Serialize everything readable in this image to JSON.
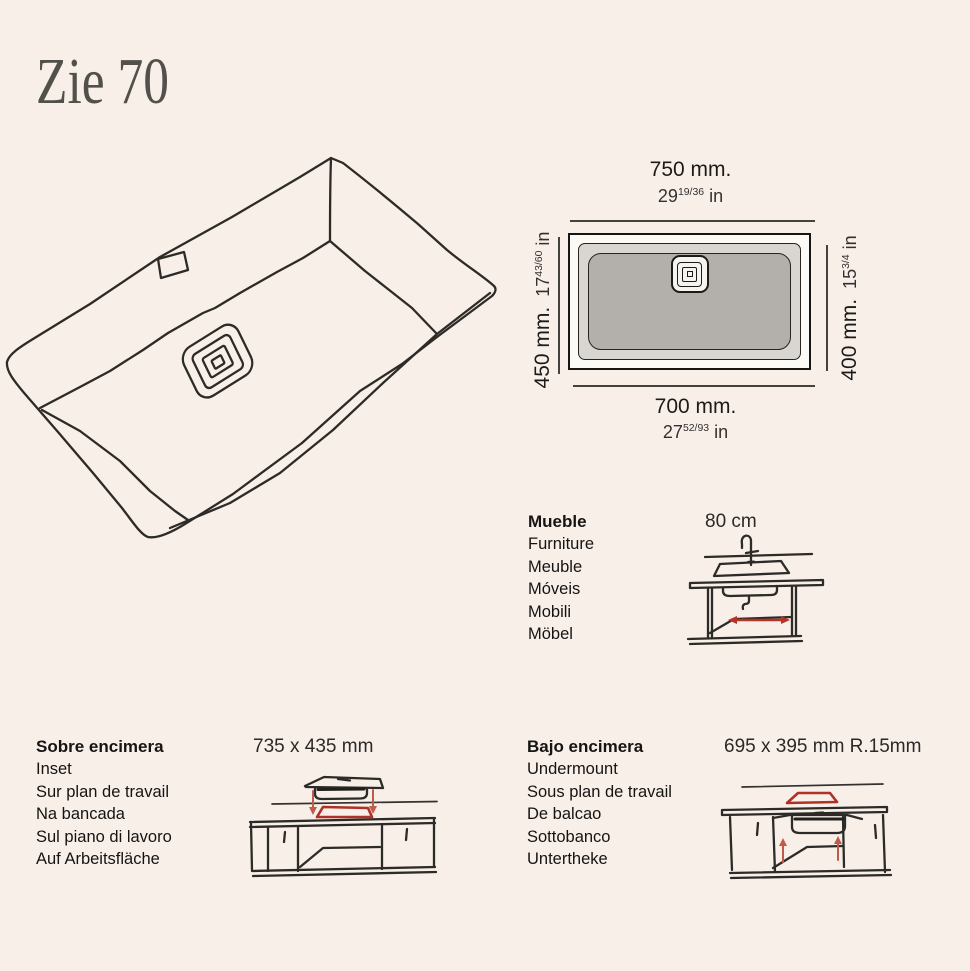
{
  "title": "Zie 70",
  "colors": {
    "background": "#f8efe9",
    "line_ink": "#2d2b27",
    "accent_red": "#ad3227",
    "basin_gray": "#b3b0ac",
    "rim_gray": "#d9d6d2"
  },
  "dimension_diagram": {
    "width_top": {
      "mm": "750 mm.",
      "in_whole": "29",
      "in_frac": "19/36",
      "in_unit": "in"
    },
    "width_bottom": {
      "mm": "700 mm.",
      "in_whole": "27",
      "in_frac": "52/93",
      "in_unit": "in"
    },
    "depth_left": {
      "mm": "450 mm.",
      "in_whole": "17",
      "in_frac": "43/60",
      "in_unit": "in"
    },
    "depth_right": {
      "mm": "400 mm.",
      "in_whole": "15",
      "in_frac": "3/4",
      "in_unit": "in"
    }
  },
  "cabinet_section": {
    "heading": "Mueble",
    "translations": [
      "Furniture",
      "Meuble",
      "Móveis",
      "Mobili",
      "Möbel"
    ],
    "size": "80 cm"
  },
  "inset_section": {
    "heading": "Sobre encimera",
    "translations": [
      "Inset",
      "Sur plan de travail",
      "Na bancada",
      "Sul piano di lavoro",
      "Auf Arbeitsfläche"
    ],
    "size": "735 x 435 mm"
  },
  "undermount_section": {
    "heading": "Bajo encimera",
    "translations": [
      "Undermount",
      "Sous plan de travail",
      "De balcao",
      "Sottobanco",
      "Untertheke"
    ],
    "size": "695 x 395 mm R.15mm"
  }
}
